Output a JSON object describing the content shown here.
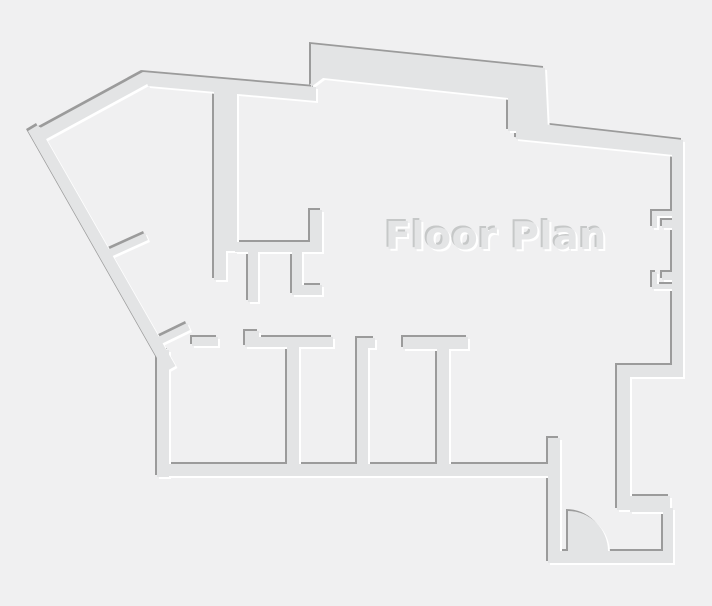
{
  "title": {
    "text": "Floor Plan"
  },
  "canvas": {
    "background": "#f0f0f1",
    "wall_fill": "#e3e4e5",
    "shadow_dark": "#9b9b9b",
    "highlight": "#ffffff",
    "text_fill": "#e4e5e6",
    "text_shadow": "#c6c8c8"
  }
}
